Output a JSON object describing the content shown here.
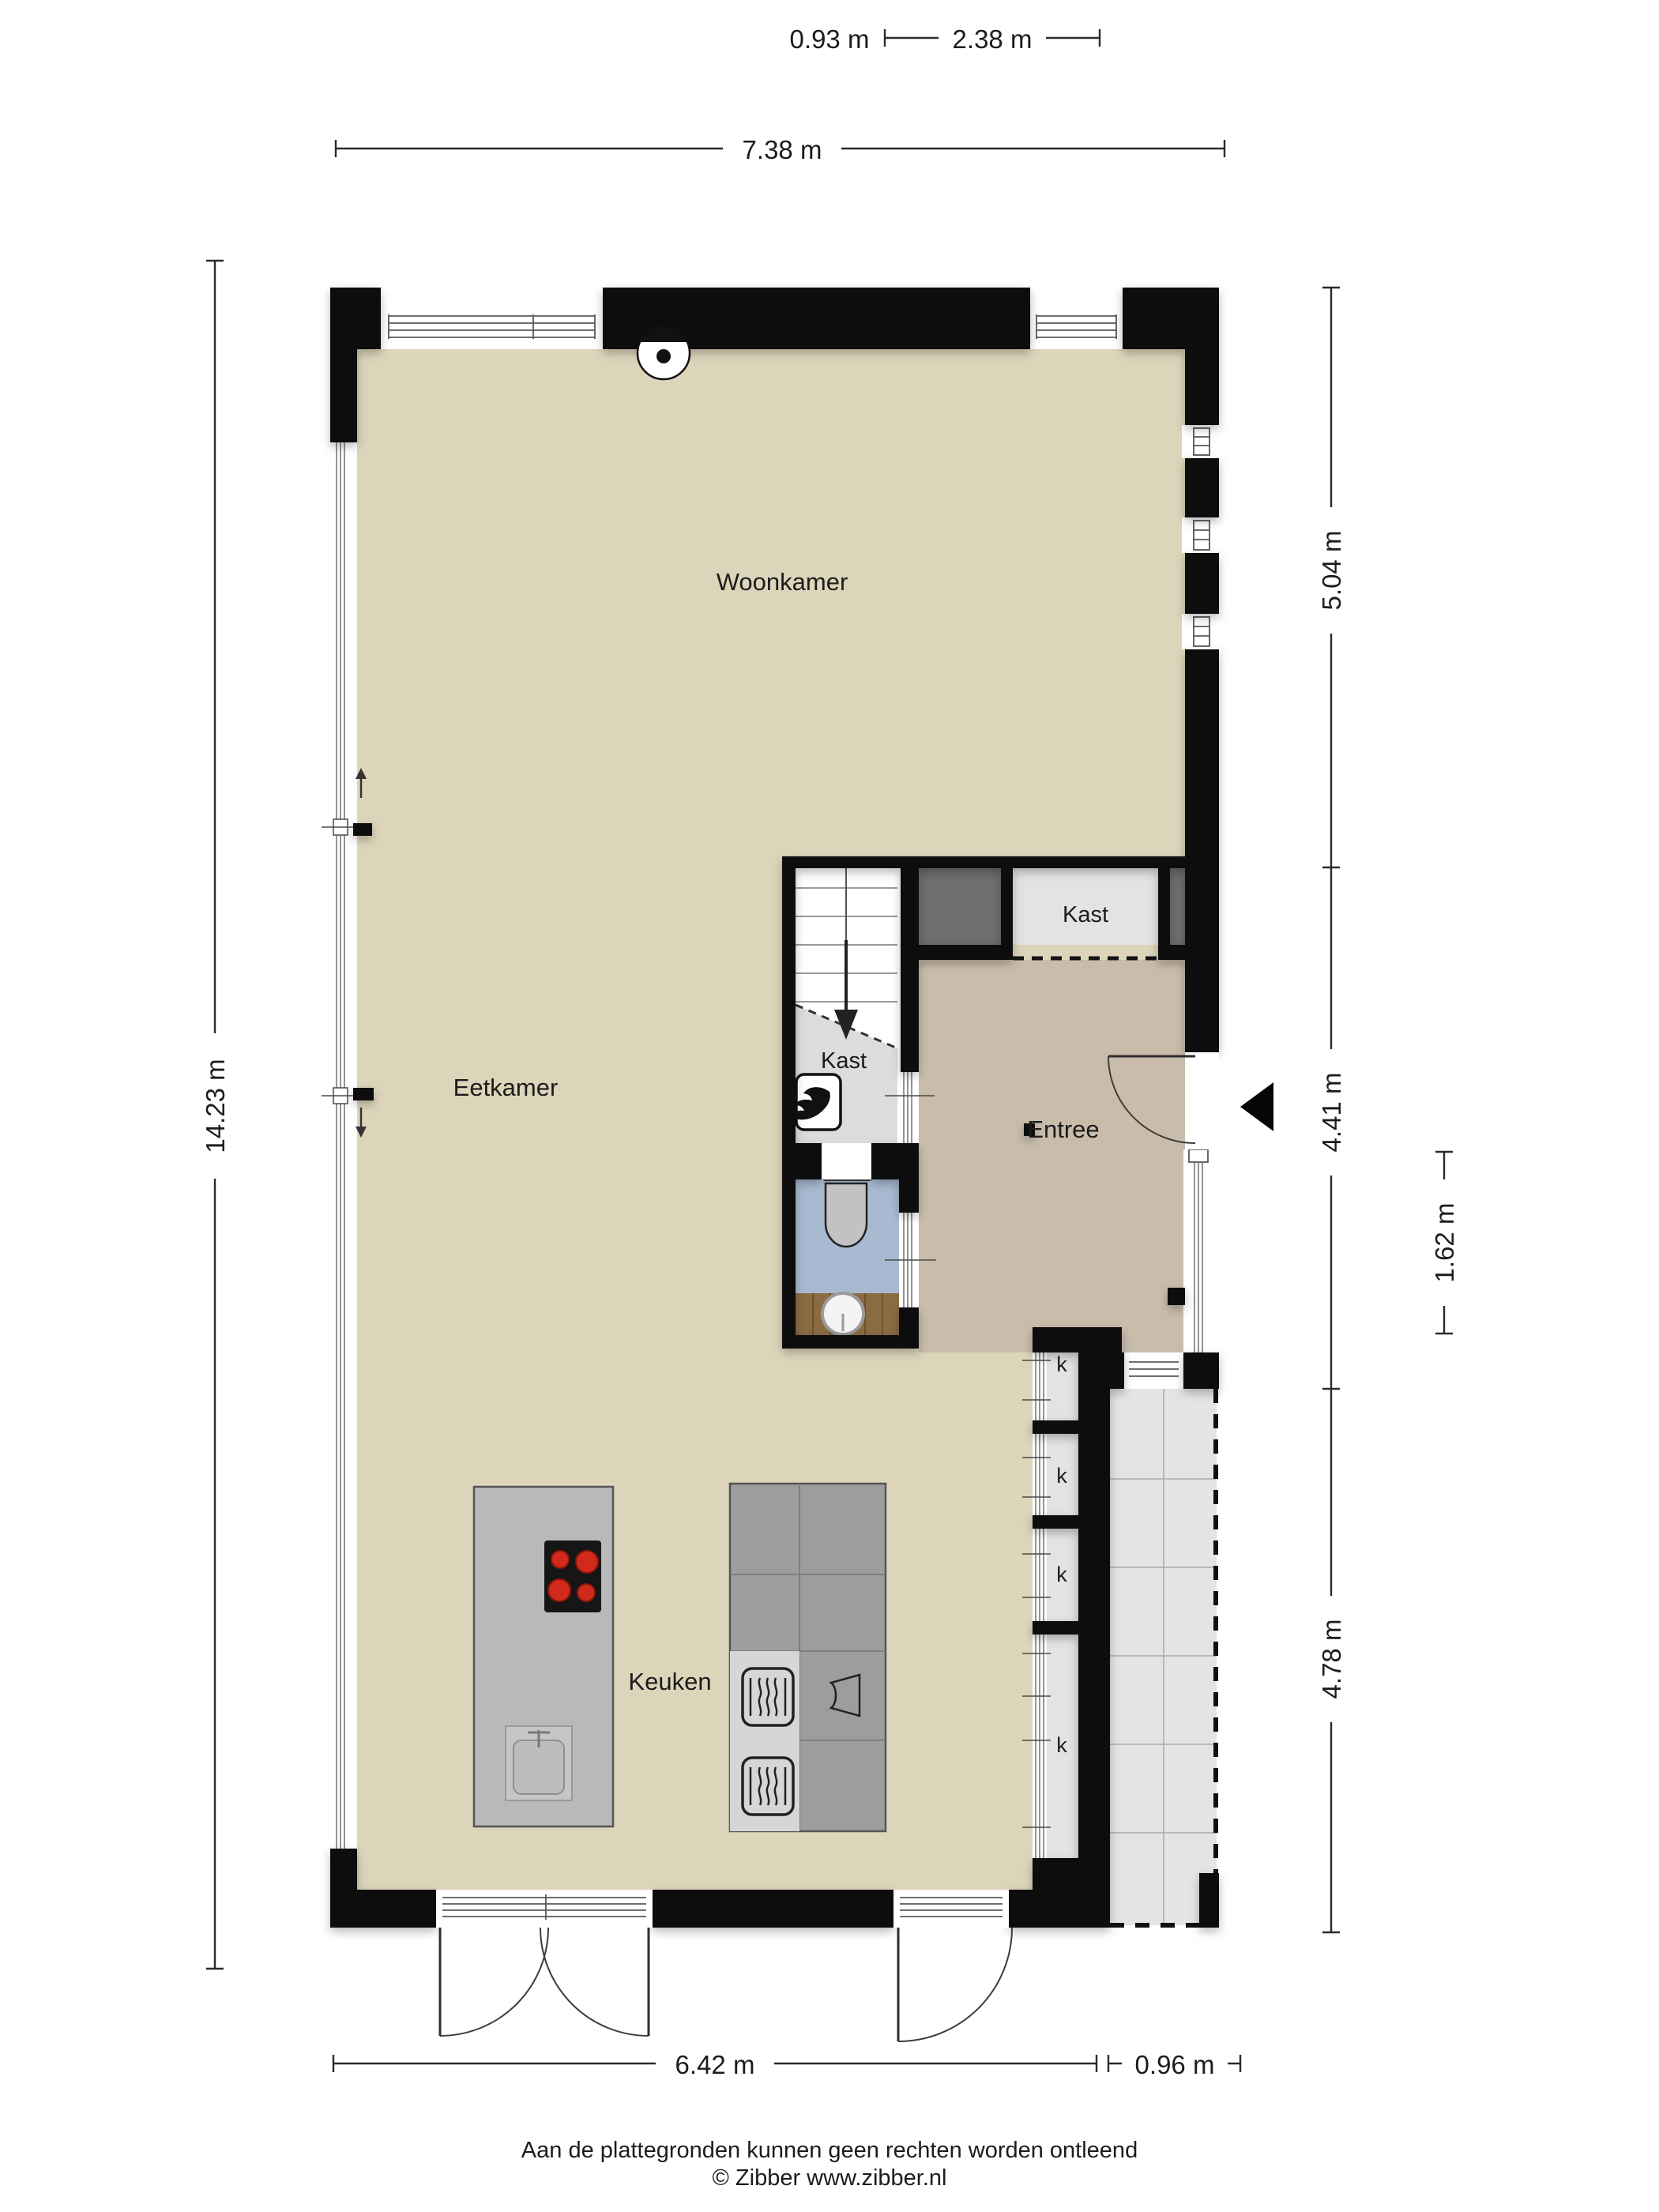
{
  "footer": {
    "line1": "Aan de plattegronden kunnen geen rechten worden ontleend",
    "line2": "© Zibber www.zibber.nl"
  },
  "rooms": {
    "woonkamer": "Woonkamer",
    "eetkamer": "Eetkamer",
    "keuken": "Keuken",
    "entree": "Entree",
    "kast_upper": "Kast",
    "kast_under_stairs": "Kast"
  },
  "labels": {
    "closets": [
      "k",
      "k",
      "k",
      "k"
    ]
  },
  "dimensions": {
    "width_stairs": "0.93 m",
    "width_closets": "2.38 m",
    "width_total": "7.38 m",
    "height_total": "14.23 m",
    "right_upper": "5.04 m",
    "right_entree": "4.41 m",
    "entree_inner": "1.62 m",
    "right_lower": "4.78 m",
    "bottom_interior": "6.42 m",
    "bottom_terrace": "0.96 m"
  },
  "colors": {
    "wall": "#0a0a0a",
    "floor_main": "#ddd5ba",
    "floor_entree": "#c9bcab",
    "floor_toilet": "#a8bad1",
    "floor_closet": "#e3e3e3",
    "floor_terrace": "#e4e4e4",
    "closet_dark": "#6e6e6e",
    "stairs_understair": "#dcdcdc",
    "wood": "#8b6b42",
    "burner_red": "#cf2a1b",
    "island_gray": "#b9b9b9",
    "counter_gray": "#9d9d9d",
    "appliance_light": "#d6d6d6"
  },
  "icons": {
    "ceiling_vent": "ceiling-vent-icon",
    "boiler_flame": "boiler-flame-icon",
    "entrance_arrow": "entrance-direction-arrow",
    "stairs_arrow": "stairs-down-arrow",
    "window_arrow_up": "window-direction-up-arrow",
    "window_arrow_down": "window-direction-down-arrow"
  }
}
